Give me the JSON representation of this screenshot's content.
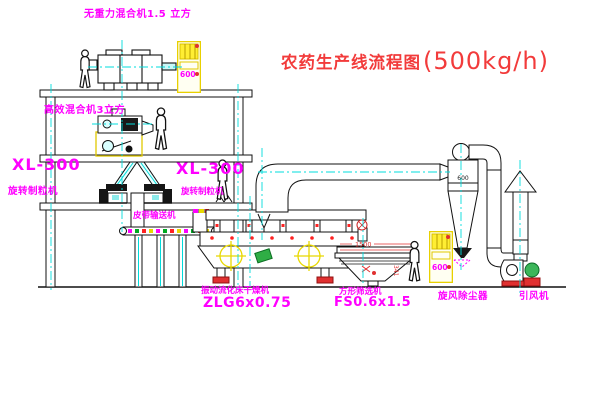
{
  "title": {
    "name": "农药生产线流程图",
    "capacity": "(500kg/h)"
  },
  "equipment_labels": {
    "top_mixer": "无重力混合机1.5 立方",
    "mid_mixer": "高效混合机3立方",
    "granulator_left_model": "XL-300",
    "granulator_left_name": "旋转制粒机",
    "granulator_mid_model": "XL-300",
    "granulator_mid_name": "旋转制粒机",
    "belt_conveyor": "皮带输送机",
    "dryer_name": "振动流化床干燥机",
    "dryer_model": "ZLG6x0.75",
    "sieve_name": "方形筛选机",
    "sieve_model": "FS0.6x1.5",
    "cyclone": "旋风除尘器",
    "fan": "引风机"
  },
  "annotations": {
    "cabinet1_text": "600",
    "cabinet2_text": "600",
    "cyclone_diameter": "600",
    "sieve_dim_width": "1500",
    "sieve_dim_height": "341"
  },
  "colors": {
    "label_magenta": "#ff00ff",
    "title_red": "#f23b3b",
    "line_black": "#111111",
    "centerline_cyan": "#00dcdc",
    "cabinet_yellow": "#e8d000",
    "alert_red": "#e03030",
    "motor_green": "#2fae45"
  }
}
